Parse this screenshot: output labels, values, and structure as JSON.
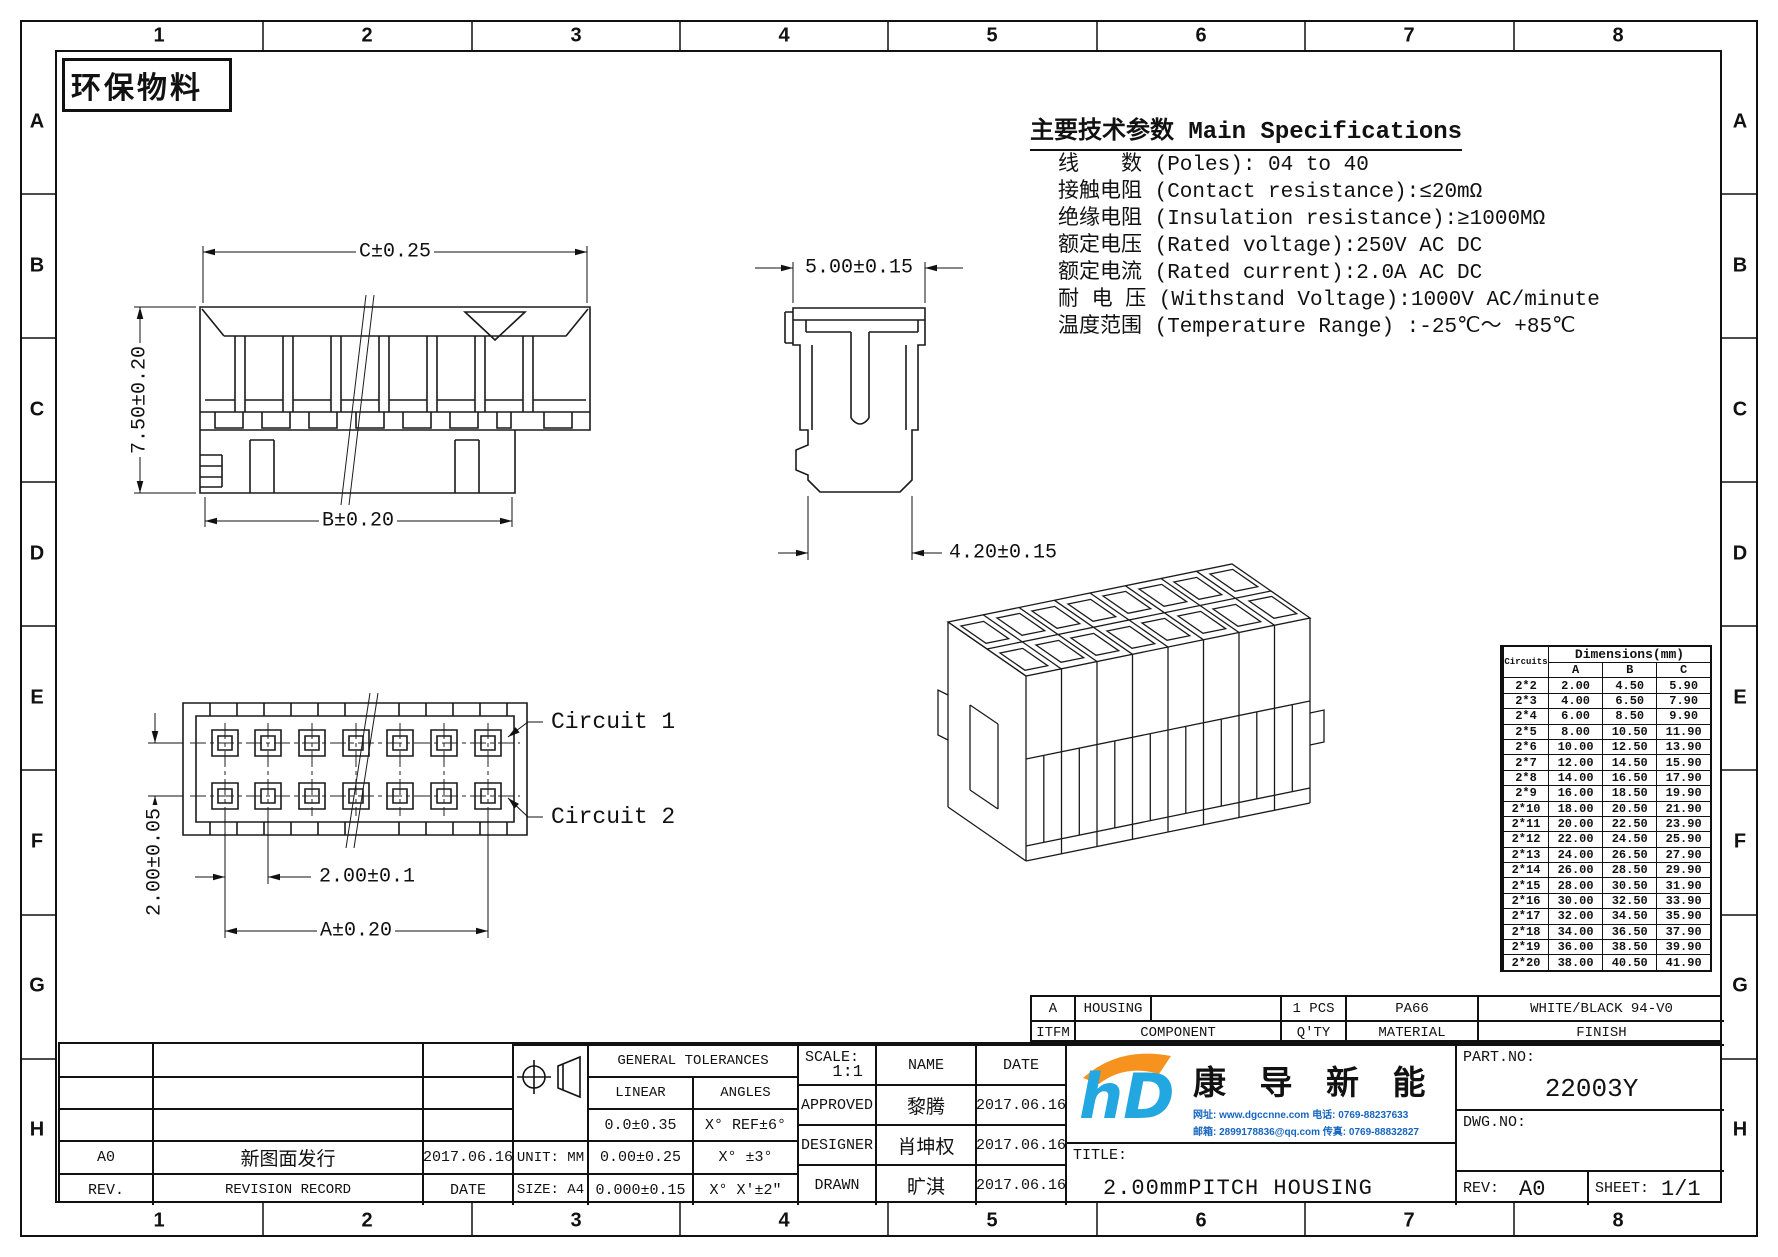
{
  "frame": {
    "eco_label": "环保物料",
    "cols": [
      "1",
      "2",
      "3",
      "4",
      "5",
      "6",
      "7",
      "8"
    ],
    "rows": [
      "A",
      "B",
      "C",
      "D",
      "E",
      "F",
      "G",
      "H"
    ]
  },
  "specs": {
    "title": "主要技术参数 Main Specifications",
    "lines": [
      "线　　数 (Poles): 04 to 40",
      "接触电阻 (Contact resistance):≤20mΩ",
      "绝缘电阻 (Insulation resistance):≥1000MΩ",
      "额定电压 (Rated voltage):250V AC DC",
      "额定电流 (Rated current):2.0A AC DC",
      "耐 电 压 (Withstand Voltage):1000V AC/minute",
      "温度范围 (Temperature Range) :-25℃～ +85℃"
    ]
  },
  "dims": {
    "front_top": "C±0.25",
    "front_left": "7.50±0.20",
    "front_bottom": "B±0.20",
    "side_top": "5.00±0.15",
    "side_bottom": "4.20±0.15",
    "row_pitch": "2.00±0.05",
    "col_pitch": "2.00±0.1",
    "span": "A±0.20",
    "circuit1": "Circuit 1",
    "circuit2": "Circuit 2"
  },
  "dim_table": {
    "corner": "Circuits",
    "title": "Dimensions(mm)",
    "columns": [
      "A",
      "B",
      "C"
    ],
    "rows": [
      [
        "2*2",
        "2.00",
        "4.50",
        "5.90"
      ],
      [
        "2*3",
        "4.00",
        "6.50",
        "7.90"
      ],
      [
        "2*4",
        "6.00",
        "8.50",
        "9.90"
      ],
      [
        "2*5",
        "8.00",
        "10.50",
        "11.90"
      ],
      [
        "2*6",
        "10.00",
        "12.50",
        "13.90"
      ],
      [
        "2*7",
        "12.00",
        "14.50",
        "15.90"
      ],
      [
        "2*8",
        "14.00",
        "16.50",
        "17.90"
      ],
      [
        "2*9",
        "16.00",
        "18.50",
        "19.90"
      ],
      [
        "2*10",
        "18.00",
        "20.50",
        "21.90"
      ],
      [
        "2*11",
        "20.00",
        "22.50",
        "23.90"
      ],
      [
        "2*12",
        "22.00",
        "24.50",
        "25.90"
      ],
      [
        "2*13",
        "24.00",
        "26.50",
        "27.90"
      ],
      [
        "2*14",
        "26.00",
        "28.50",
        "29.90"
      ],
      [
        "2*15",
        "28.00",
        "30.50",
        "31.90"
      ],
      [
        "2*16",
        "30.00",
        "32.50",
        "33.90"
      ],
      [
        "2*17",
        "32.00",
        "34.50",
        "35.90"
      ],
      [
        "2*18",
        "34.00",
        "36.50",
        "37.90"
      ],
      [
        "2*19",
        "36.00",
        "38.50",
        "39.90"
      ],
      [
        "2*20",
        "38.00",
        "40.50",
        "41.90"
      ]
    ]
  },
  "bom": {
    "item_no": "A",
    "component": "HOUSING",
    "qty": "1 PCS",
    "material": "PA66",
    "finish": "WHITE/BLACK 94-V0",
    "h_item": "ITFM",
    "h_component": "COMPONENT",
    "h_qty": "Q'TY",
    "h_material": "MATERIAL",
    "h_finish": "FINISH"
  },
  "title_block": {
    "rev_value": "A0",
    "rev_record": "新图面发行",
    "rev_date": "2017.06.16",
    "rev_label": "REV.",
    "record_label": "REVISION RECORD",
    "date_label": "DATE",
    "unit": "UNIT: MM",
    "size": "SIZE: A4",
    "tol_title": "GENERAL TOLERANCES",
    "tol_linear": "LINEAR",
    "tol_angles": "ANGLES",
    "tol_l1": "0.0±0.35",
    "tol_a1": "X° REF±6°",
    "tol_l2": "0.00±0.25",
    "tol_a2": "X° ±3°",
    "tol_l3": "0.000±0.15",
    "tol_a3": "X° X'±2\"",
    "scale_label": "SCALE:",
    "scale": "1:1",
    "name_label": "NAME",
    "date_label2": "DATE",
    "approved_label": "APPROVED",
    "approved_name": "黎腾",
    "approved_date": "2017.06.16",
    "designer_label": "DESIGNER",
    "designer_name": "肖坤权",
    "designer_date": "2017.06.16",
    "drawn_label": "DRAWN",
    "drawn_name": "旷淇",
    "drawn_date": "2017.06.16",
    "title_label": "TITLE:",
    "drawing_title": "2.00mmPITCH HOUSING",
    "part_label": "PART.NO:",
    "part_no": "22003Y",
    "dwg_label": "DWG.NO:",
    "rev2_label": "REV:",
    "rev2": "A0",
    "sheet_label": "SHEET:",
    "sheet": "1/1"
  },
  "logo": {
    "mark": "hD",
    "company": "康 导 新 能 源",
    "contact1": "网址: www.dgccnne.com   电话: 0769-88237633",
    "contact2": "邮箱: 2899178836@qq.com 传真: 0769-88832827",
    "blue": "#22a7e0",
    "orange": "#f6921e"
  }
}
